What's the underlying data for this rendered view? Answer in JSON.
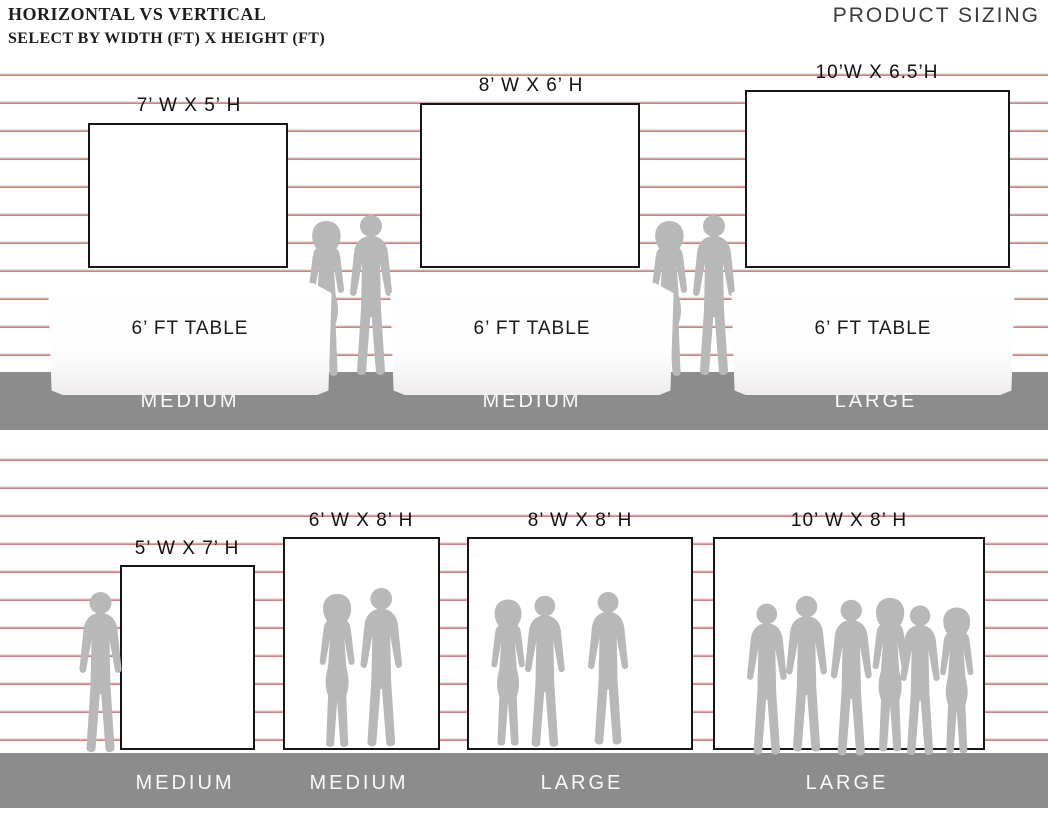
{
  "header": {
    "title_line1": "HORIZONTAL VS VERTICAL",
    "title_line2": "SELECT BY WIDTH (FT) X HEIGHT (FT)",
    "brand": "PRODUCT SIZING"
  },
  "colors": {
    "stripe": "#c98383",
    "floor": "#8c8c8c",
    "silhouette": "#b8b8b8",
    "ink": "#1c1c1c"
  },
  "top_row": {
    "items": [
      {
        "size_label": "7’ W X 5’ H",
        "table_label": "6’ FT TABLE",
        "floor_label": "MEDIUM"
      },
      {
        "size_label": "8’ W X 6’ H",
        "table_label": "6’ FT TABLE",
        "floor_label": "MEDIUM"
      },
      {
        "size_label": "10’W X 6.5’H",
        "table_label": "6’ FT TABLE",
        "floor_label": "LARGE"
      }
    ]
  },
  "bottom_row": {
    "items": [
      {
        "size_label": "5’ W X 7’ H",
        "floor_label": "MEDIUM"
      },
      {
        "size_label": "6’ W X 8’ H",
        "floor_label": "MEDIUM"
      },
      {
        "size_label": "8’ W X 8’ H",
        "floor_label": "LARGE"
      },
      {
        "size_label": "10’ W X 8’ H",
        "floor_label": "LARGE"
      }
    ]
  }
}
